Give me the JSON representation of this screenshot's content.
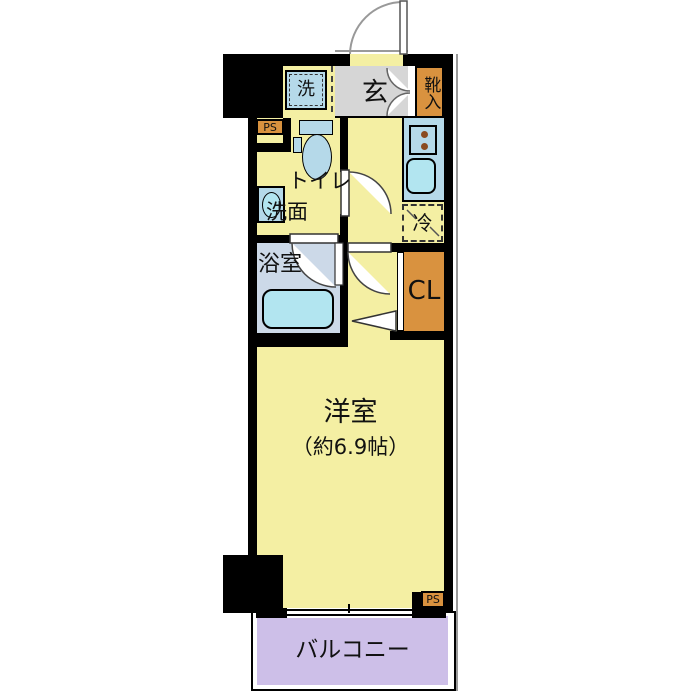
{
  "plan_type": "floor-plan",
  "rooms": {
    "entrance": {
      "label": "玄"
    },
    "shoe_cabinet": {
      "label": "靴入"
    },
    "washing_machine": {
      "label": "洗"
    },
    "washroom": {
      "toilet_label": "トイレ",
      "basin_label": "洗面"
    },
    "bathroom": {
      "label": "浴室"
    },
    "refrigerator": {
      "label": "冷"
    },
    "closet": {
      "label": "CL"
    },
    "western_room": {
      "label": "洋室",
      "size_label": "（約6.9帖）"
    },
    "balcony": {
      "label": "バルコニー"
    },
    "pipe_space_top": {
      "label": "PS"
    },
    "pipe_space_bottom": {
      "label": "PS"
    }
  },
  "colors": {
    "floor_yellow": "#f4efa3",
    "entrance_gray": "#d6d6d6",
    "storage_orange": "#d9923f",
    "fixture_blue": "#b5d9e9",
    "water_cyan": "#b2e5f0",
    "bathroom_floor": "#ccd9e8",
    "balcony_purple": "#cdbfe8",
    "wall": "#000000"
  }
}
